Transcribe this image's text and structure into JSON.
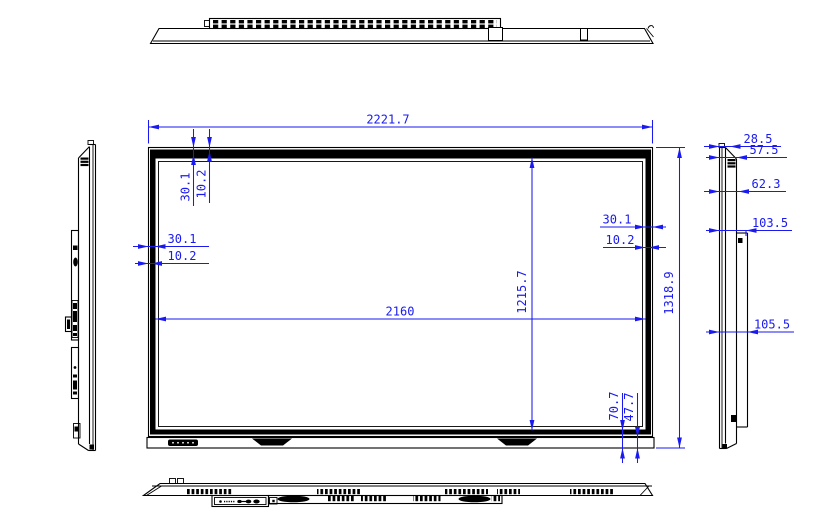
{
  "drawing": {
    "kind": "display-panel-dimension-drawing",
    "colors": {
      "linework": "#000000",
      "dimension": "#1a1af0",
      "background": "#ffffff"
    },
    "dimensions": {
      "overall_width": "2221.7",
      "active_width": "2160",
      "overall_height": "1318.9",
      "active_height": "1215.7",
      "top_bezel": "30.1",
      "top_bezel_inner": "10.2",
      "left_bezel": "30.1",
      "left_bezel_inner": "10.2",
      "right_bezel": "30.1",
      "right_bezel_inner": "10.2",
      "bottom_bezel": "70.7",
      "bottom_bezel_inner": "47.7",
      "side_depth_front": "28.5",
      "side_depth_top": "57.5",
      "side_depth_upper": "62.3",
      "side_depth_mid": "103.5",
      "side_depth_back": "105.5"
    }
  }
}
